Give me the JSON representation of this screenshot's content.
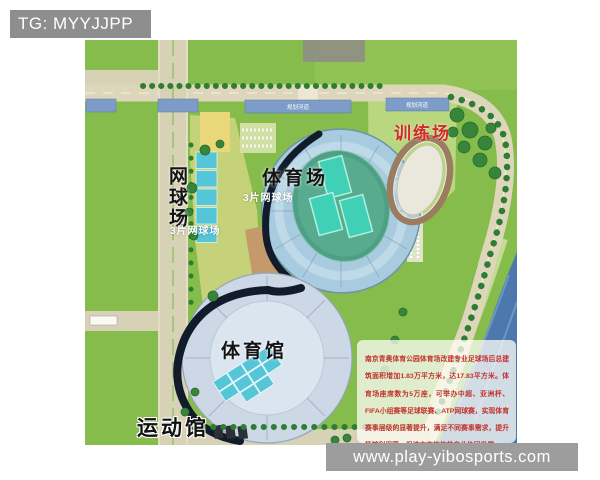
{
  "header": {
    "tag_label": "TG: MYYJJPP"
  },
  "footer": {
    "site_url": "www.play-yibosports.com"
  },
  "plan": {
    "labels": {
      "training_field": "训练场",
      "stadium": "体育场",
      "stadium_note": "3片网球场",
      "tennis_court": "网球场",
      "tennis_note": "3片网球场",
      "gymnasium": "体育馆",
      "sports_hall": "运动馆",
      "waterway": "规划河道"
    },
    "info_box": {
      "text": "南京青奥体育公园体育场改建专业足球场后总建筑面积增加1.83万平方米，达17.83平方米。体育场座席数为5万座，可举办中超、亚洲杯、FIFA小组赛等足球联赛、ATP网球赛，实现体育赛事层级的显著提升，满足不同赛事需求，提升场馆利用率，促进文商旅体艺产业协同发展。"
    },
    "colors": {
      "grass": "#85bc4b",
      "road": "#d7d1b5",
      "water": "#4c78ae",
      "stadium_bowl": "#a9cbdf",
      "field_green": "#4f9f85",
      "court_teal": "#3fd0b6",
      "court_cyan": "#54c6d8",
      "gym_roof": "#ccd8e6",
      "dark_rim": "#111b29",
      "label_red": "#d42b28"
    }
  }
}
